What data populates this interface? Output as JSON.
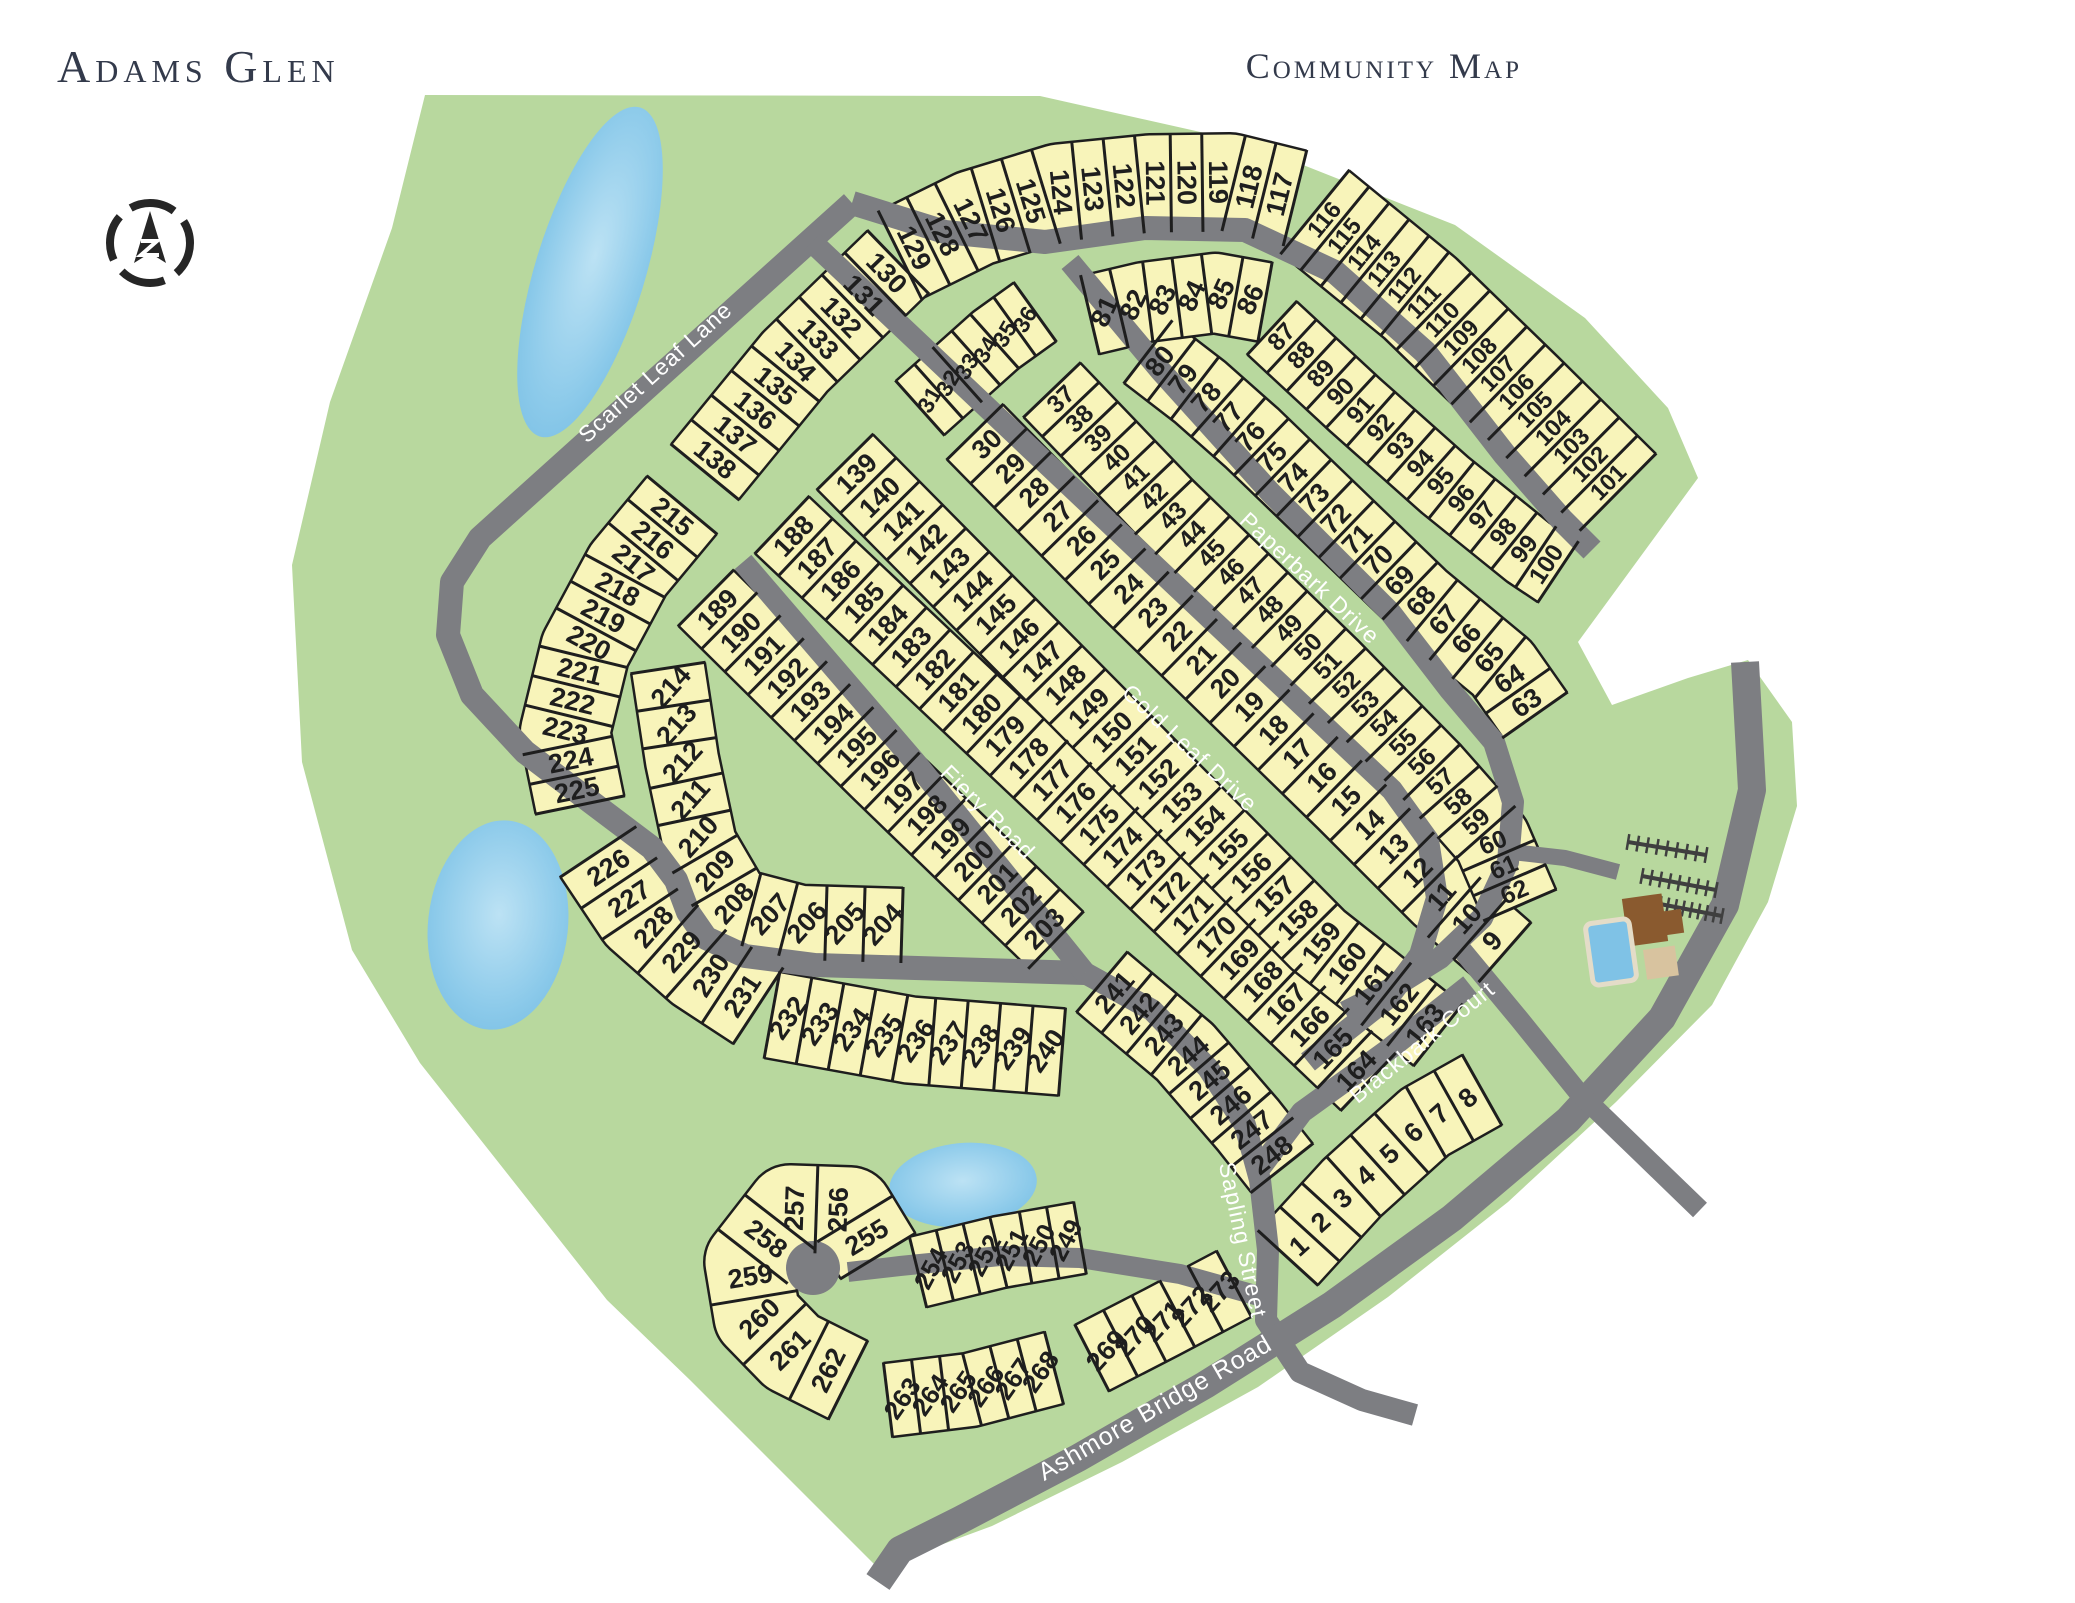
{
  "header": {
    "title": "Adams Glen",
    "subtitle": "Community Map"
  },
  "compass": {
    "label": "north-arrow",
    "x": 150,
    "y": 243,
    "r": 40
  },
  "colors": {
    "background": "#ffffff",
    "land_green": "#b8d89e",
    "lot_yellow": "#f8f4ba",
    "lot_line": "#1e1e1e",
    "road_gray": "#7d7e82",
    "pond_blue": "#7fc2e6",
    "pond_light": "#b5dff2",
    "title_navy": "#333a4b",
    "clubhouse_brown": "#8a5a2f",
    "patio_tan": "#d8c39f",
    "parking_dark": "#3f3f3f"
  },
  "map": {
    "boundary": [
      [
        425,
        95
      ],
      [
        1040,
        96
      ],
      [
        1245,
        142
      ],
      [
        1455,
        225
      ],
      [
        1585,
        318
      ],
      [
        1668,
        408
      ],
      [
        1698,
        478
      ],
      [
        1578,
        642
      ],
      [
        1612,
        705
      ],
      [
        1688,
        678
      ],
      [
        1748,
        660
      ],
      [
        1792,
        722
      ],
      [
        1797,
        806
      ],
      [
        1768,
        902
      ],
      [
        1712,
        1005
      ],
      [
        1616,
        1102
      ],
      [
        1508,
        1202
      ],
      [
        1388,
        1297
      ],
      [
        1258,
        1387
      ],
      [
        1122,
        1462
      ],
      [
        992,
        1526
      ],
      [
        878,
        1568
      ],
      [
        690,
        1380
      ],
      [
        607,
        1300
      ],
      [
        420,
        1063
      ],
      [
        352,
        950
      ],
      [
        302,
        762
      ],
      [
        292,
        565
      ],
      [
        330,
        402
      ],
      [
        392,
        228
      ]
    ],
    "ponds": [
      {
        "name": "north-pond",
        "cx": 590,
        "cy": 272,
        "rx": 55,
        "ry": 172,
        "rot": 17
      },
      {
        "name": "west-pond",
        "cx": 498,
        "cy": 925,
        "rx": 70,
        "ry": 105,
        "rot": 6
      },
      {
        "name": "south-pond",
        "cx": 963,
        "cy": 1185,
        "rx": 74,
        "ry": 42,
        "rot": -5
      }
    ],
    "roads": [
      {
        "id": "scarlet-leaf-lane",
        "name": "Scarlet Leaf Lane",
        "width": 24,
        "points": [
          [
            852,
            203
          ],
          [
            480,
            538
          ],
          [
            452,
            582
          ],
          [
            448,
            635
          ],
          [
            472,
            695
          ],
          [
            525,
            752
          ],
          [
            595,
            805
          ],
          [
            652,
            848
          ],
          [
            676,
            880
          ],
          [
            688,
            912
          ],
          [
            706,
            938
          ],
          [
            745,
            956
          ],
          [
            815,
            965
          ],
          [
            1085,
            973
          ]
        ],
        "label": {
          "x": 655,
          "y": 372,
          "angle": -42,
          "size": 23
        }
      },
      {
        "id": "ring-arc",
        "name": "",
        "width": 24,
        "points": [
          [
            852,
            203
          ],
          [
            945,
            232
          ],
          [
            1045,
            242
          ],
          [
            1145,
            228
          ],
          [
            1245,
            230
          ],
          [
            1335,
            272
          ],
          [
            1425,
            352
          ],
          [
            1505,
            455
          ],
          [
            1562,
            520
          ],
          [
            1592,
            550
          ]
        ]
      },
      {
        "id": "paperbark-drive",
        "name": "Paperbark Drive",
        "width": 22,
        "points": [
          [
            1070,
            262
          ],
          [
            1160,
            370
          ],
          [
            1270,
            492
          ],
          [
            1390,
            612
          ],
          [
            1450,
            690
          ],
          [
            1494,
            742
          ],
          [
            1513,
            802
          ],
          [
            1508,
            862
          ],
          [
            1482,
            918
          ],
          [
            1440,
            958
          ],
          [
            1392,
            988
          ],
          [
            1345,
            1012
          ]
        ],
        "label": {
          "x": 1310,
          "y": 578,
          "angle": 43,
          "size": 23
        }
      },
      {
        "id": "gold-leaf-drive",
        "name": "Gold Leaf Drive",
        "width": 22,
        "points": [
          [
            812,
            242
          ],
          [
            1140,
            552
          ],
          [
            1392,
            790
          ],
          [
            1428,
            840
          ],
          [
            1437,
            898
          ],
          [
            1420,
            955
          ],
          [
            1388,
            998
          ],
          [
            1345,
            1032
          ],
          [
            1308,
            1062
          ]
        ],
        "label": {
          "x": 1190,
          "y": 748,
          "angle": 43,
          "size": 23
        }
      },
      {
        "id": "fiery-road",
        "name": "Fiery Road",
        "width": 22,
        "points": [
          [
            743,
            562
          ],
          [
            915,
            762
          ],
          [
            1085,
            973
          ]
        ],
        "label": {
          "x": 988,
          "y": 812,
          "angle": 45,
          "size": 23
        }
      },
      {
        "id": "blackbark-court",
        "name": "Blackbark Court",
        "width": 22,
        "points": [
          [
            1470,
            985
          ],
          [
            1388,
            1050
          ],
          [
            1302,
            1112
          ],
          [
            1260,
            1168
          ]
        ],
        "label": {
          "x": 1422,
          "y": 1042,
          "angle": -39,
          "size": 23
        }
      },
      {
        "id": "sapling-street",
        "name": "Sapling Street",
        "width": 22,
        "points": [
          [
            1085,
            973
          ],
          [
            1152,
            1010
          ],
          [
            1208,
            1068
          ],
          [
            1245,
            1125
          ],
          [
            1260,
            1180
          ],
          [
            1268,
            1250
          ],
          [
            1266,
            1320
          ],
          [
            1300,
            1372
          ],
          [
            1362,
            1400
          ],
          [
            1415,
            1415
          ]
        ],
        "label": {
          "x": 1243,
          "y": 1240,
          "angle": 78,
          "size": 23
        }
      },
      {
        "id": "ashmore-bridge-road",
        "name": "Ashmore Bridge Road",
        "width": 28,
        "points": [
          [
            1745,
            662
          ],
          [
            1752,
            790
          ],
          [
            1725,
            905
          ],
          [
            1662,
            1018
          ],
          [
            1568,
            1120
          ],
          [
            1452,
            1218
          ],
          [
            1332,
            1305
          ],
          [
            1205,
            1385
          ],
          [
            1078,
            1458
          ],
          [
            960,
            1520
          ],
          [
            900,
            1550
          ],
          [
            878,
            1582
          ]
        ],
        "label": {
          "x": 1155,
          "y": 1408,
          "angle": -30,
          "size": 25
        }
      },
      {
        "id": "cul-de-sac-street",
        "name": "",
        "width": 20,
        "points": [
          [
            1266,
            1298
          ],
          [
            1180,
            1274
          ],
          [
            1080,
            1258
          ],
          [
            1000,
            1256
          ],
          [
            900,
            1266
          ],
          [
            848,
            1272
          ]
        ]
      },
      {
        "id": "south-connector",
        "name": "",
        "width": 20,
        "points": [
          [
            1462,
            950
          ],
          [
            1520,
            1020
          ],
          [
            1578,
            1092
          ],
          [
            1640,
            1152
          ],
          [
            1700,
            1210
          ]
        ]
      },
      {
        "id": "amenity-drive",
        "name": "",
        "width": 16,
        "points": [
          [
            1512,
            852
          ],
          [
            1565,
            858
          ],
          [
            1618,
            872
          ]
        ]
      }
    ],
    "cul_de_sac_bulb": {
      "x": 813,
      "y": 1268,
      "r": 27
    },
    "lot_strips": [
      {
        "from": 129,
        "to": 117,
        "depth": 95,
        "path": [
          [
            900,
            255
          ],
          [
            975,
            218
          ],
          [
            1060,
            192
          ],
          [
            1150,
            183
          ],
          [
            1230,
            182
          ],
          [
            1295,
            198
          ]
        ]
      },
      {
        "from": 116,
        "to": 101,
        "depth": 105,
        "path": [
          [
            1315,
            212
          ],
          [
            1420,
            298
          ],
          [
            1520,
            395
          ],
          [
            1618,
            492
          ]
        ]
      },
      {
        "from": 130,
        "to": 138,
        "depth": 85,
        "path": [
          [
            898,
            262
          ],
          [
            795,
            362
          ],
          [
            705,
            472
          ]
        ]
      },
      {
        "from": 215,
        "to": 225,
        "depth": 88,
        "path": [
          [
            682,
            505
          ],
          [
            628,
            570
          ],
          [
            585,
            650
          ],
          [
            565,
            732
          ],
          [
            580,
            805
          ]
        ]
      },
      {
        "from": 226,
        "to": 231,
        "depth": 88,
        "path": [
          [
            598,
            852
          ],
          [
            640,
            915
          ],
          [
            700,
            968
          ],
          [
            758,
            1006
          ]
        ]
      },
      {
        "from": 232,
        "to": 240,
        "depth": 85,
        "textAngle": -55,
        "path": [
          [
            772,
            1015
          ],
          [
            910,
            1040
          ],
          [
            1062,
            1052
          ]
        ]
      },
      {
        "from": 214,
        "to": 204,
        "depth": 72,
        "textAngle": -48,
        "path": [
          [
            668,
            668
          ],
          [
            682,
            760
          ],
          [
            700,
            845
          ],
          [
            735,
            905
          ],
          [
            800,
            922
          ],
          [
            902,
            925
          ]
        ]
      },
      {
        "from": 189,
        "to": 203,
        "depth": 76,
        "path": [
          [
            706,
            598
          ],
          [
            880,
            770
          ],
          [
            1056,
            940
          ]
        ]
      },
      {
        "from": 188,
        "to": 164,
        "depth": 76,
        "path": [
          [
            782,
            525
          ],
          [
            1075,
            802
          ],
          [
            1368,
            1082
          ]
        ]
      },
      {
        "from": 139,
        "to": 163,
        "depth": 76,
        "path": [
          [
            845,
            462
          ],
          [
            1140,
            760
          ],
          [
            1318,
            940
          ],
          [
            1438,
            1035
          ]
        ]
      },
      {
        "from": 30,
        "to": 9,
        "depth": 76,
        "path": [
          [
            975,
            432
          ],
          [
            1130,
            590
          ],
          [
            1345,
            800
          ],
          [
            1440,
            895
          ],
          [
            1505,
            952
          ]
        ]
      },
      {
        "from": 31,
        "to": 36,
        "depth": 70,
        "textAngle": -60,
        "path": [
          [
            920,
            408
          ],
          [
            958,
            374
          ],
          [
            996,
            340
          ],
          [
            1035,
            312
          ]
        ]
      },
      {
        "from": 37,
        "to": 62,
        "depth": 76,
        "path": [
          [
            1052,
            390
          ],
          [
            1165,
            508
          ],
          [
            1330,
            668
          ],
          [
            1432,
            772
          ],
          [
            1492,
            840
          ],
          [
            1520,
            905
          ]
        ]
      },
      {
        "from": 80,
        "to": 63,
        "depth": 76,
        "path": [
          [
            1148,
            352
          ],
          [
            1200,
            392
          ],
          [
            1252,
            438
          ],
          [
            1420,
            600
          ],
          [
            1502,
            668
          ],
          [
            1535,
            715
          ]
        ]
      },
      {
        "from": 81,
        "to": 86,
        "depth": 78,
        "textAngle": -65,
        "path": [
          [
            1090,
            315
          ],
          [
            1145,
            302
          ],
          [
            1215,
            293
          ],
          [
            1265,
            302
          ]
        ]
      },
      {
        "from": 87,
        "to": 100,
        "depth": 70,
        "path": [
          [
            1272,
            328
          ],
          [
            1355,
            405
          ],
          [
            1445,
            485
          ],
          [
            1528,
            552
          ],
          [
            1558,
            572
          ]
        ]
      },
      {
        "from": 1,
        "to": 8,
        "depth": 78,
        "textAngle": -42,
        "path": [
          [
            1288,
            1258
          ],
          [
            1352,
            1188
          ],
          [
            1425,
            1122
          ],
          [
            1482,
            1090
          ]
        ]
      },
      {
        "from": 241,
        "to": 248,
        "depth": 76,
        "path": [
          [
            1102,
            982
          ],
          [
            1185,
            1052
          ],
          [
            1248,
            1125
          ],
          [
            1282,
            1168
          ]
        ]
      },
      {
        "from": 249,
        "to": 254,
        "depth": 70,
        "textAngle": -62,
        "path": [
          [
            1080,
            1238
          ],
          [
            1000,
            1252
          ],
          [
            918,
            1272
          ]
        ]
      },
      {
        "from": 255,
        "to": 262,
        "depth": 85,
        "path": [
          [
            878,
            1256
          ],
          [
            850,
            1210
          ],
          [
            790,
            1208
          ],
          [
            748,
            1262
          ],
          [
            757,
            1316
          ],
          [
            792,
            1352
          ],
          [
            848,
            1380
          ]
        ]
      },
      {
        "from": 263,
        "to": 268,
        "depth": 72,
        "textAngle": -55,
        "path": [
          [
            888,
            1400
          ],
          [
            970,
            1390
          ],
          [
            1054,
            1368
          ]
        ]
      },
      {
        "from": 269,
        "to": 273,
        "depth": 72,
        "textAngle": -48,
        "path": [
          [
            1092,
            1358
          ],
          [
            1162,
            1322
          ],
          [
            1234,
            1284
          ]
        ]
      }
    ],
    "amenity": {
      "pool": {
        "name": "swimming-pool",
        "x": 1589,
        "y": 921,
        "w": 44,
        "h": 62,
        "rot": -8
      },
      "clubhouse": {
        "name": "clubhouse",
        "cx": 1645,
        "cy": 920,
        "rects": [
          [
            1625,
            896,
            40,
            48
          ],
          [
            1608,
            914,
            74,
            24
          ]
        ],
        "rot": -8
      },
      "patio": {
        "name": "patio",
        "x": 1643,
        "y": 950,
        "w": 32,
        "h": 30,
        "rot": -8
      },
      "parking_rows": [
        [
          1628,
          842,
          1706,
          855
        ],
        [
          1642,
          876,
          1716,
          890
        ],
        [
          1660,
          904,
          1722,
          916
        ]
      ],
      "parking_ticks_per_row": 9
    }
  }
}
